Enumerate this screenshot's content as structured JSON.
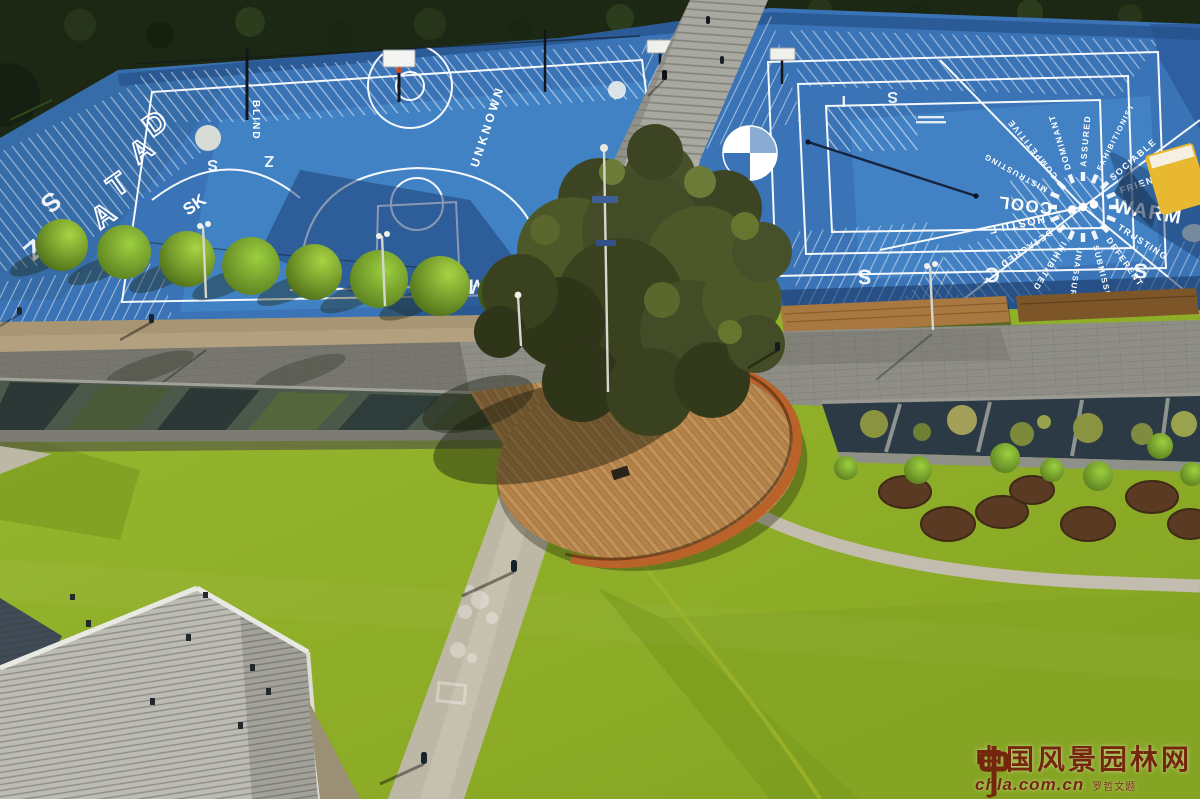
{
  "palette": {
    "court_blue": "#3a74b6",
    "court_blue_bright": "#4a90d2",
    "court_shadow_navy": "#1c3a6e",
    "lawn_green": "#8fae28",
    "lawn_green_dark": "#7c9c1e",
    "hedge_green": "#1d2814",
    "deck_wood": "#b5834a",
    "corten_orange": "#bf6428",
    "promenade_grey": "#8e8e86",
    "roof_grey": "#bcbcb4",
    "gravel_tan": "#b3a07f",
    "line_white": "#ffffff",
    "watermark": "#731d0c",
    "equipment_yellow": "#e8b830"
  },
  "watermark": {
    "site_name": "中国风景园林网",
    "site_url": "chla.com.cn",
    "calligraphy_credit": "罗哲文题"
  },
  "court": {
    "left": {
      "word_vertical": "BLIND",
      "word_diagonal": "UNKNOWN",
      "letters_diagonal": [
        "D",
        "A",
        "T",
        "A"
      ],
      "letters_small": "SK"
    },
    "wheel": {
      "words": [
        "WARM",
        "TRUSTING",
        "DEFERENT",
        "SUBMISSIVE",
        "UNASSURED",
        "INHIBITED",
        "DETACHED",
        "HOSTILE",
        "COOL",
        "MISTRUSTING",
        "COMPETITIVE",
        "DOMINANT",
        "ASSURED",
        "EXHIBITIONIST",
        "SOCIABLE",
        "FRIENDLY"
      ]
    },
    "edge_glyphs": {
      "bottom": [
        "M",
        "M",
        "F",
        "I",
        "Z",
        "S",
        "C",
        "S"
      ],
      "top": [
        "S",
        "Z",
        "I",
        "S"
      ],
      "left": [
        "S",
        "Z"
      ]
    }
  }
}
